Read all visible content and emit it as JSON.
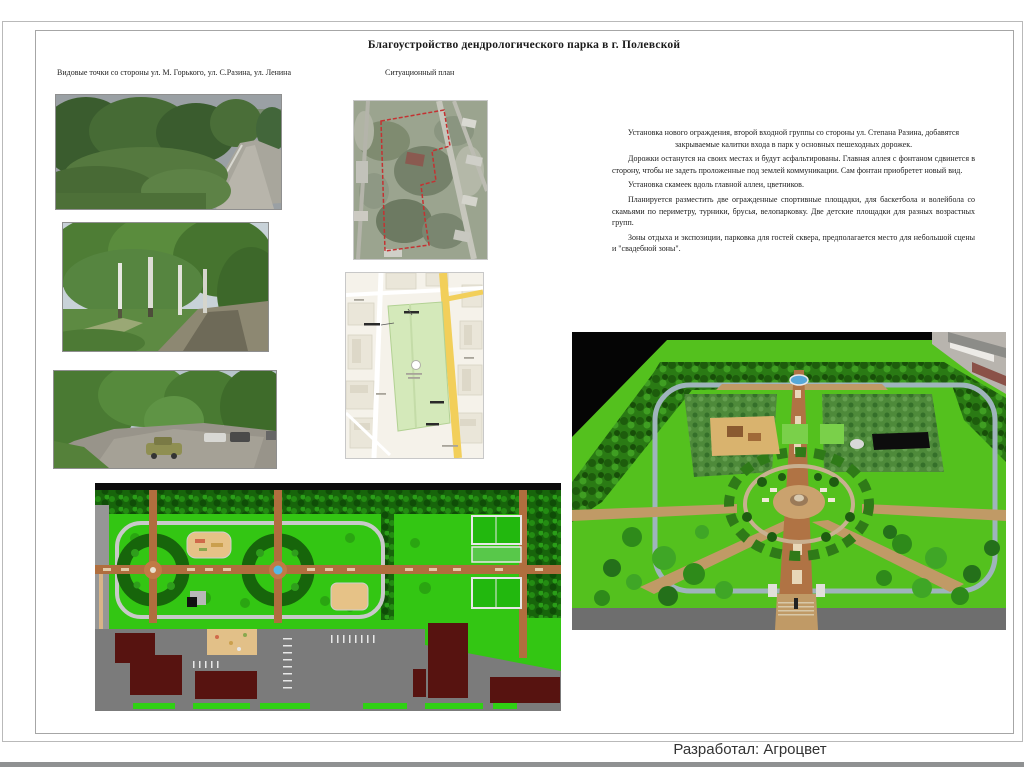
{
  "page": {
    "title": "Благоустройство дендрологического парка в г. Полевской",
    "captions": {
      "viewpoints": "Видовые точки со стороны ул. М. Горького, ул. С.Разина, ул. Ленина",
      "situational": "Ситуационный план"
    },
    "description": {
      "paragraphs": [
        "Установка нового ограждения, второй входной группы со стороны ул. Степана Разина, добавятся закрываемые калитки входа в парк у основных пешеходных дорожек.",
        "Дорожки останутся на своих местах и будут асфальтированы. Главная аллея с фонтаном сдвинется в сторону, чтобы не задеть проложенные под землей коммуникации. Сам фонтан приобретет новый вид.",
        "Установка скамеек вдоль главной аллеи, цветников.",
        "Планируется разместить две огражденные спортивные площадки, для баскетбола и волейбола со скамьями по периметру, турники, брусья, велопарковку. Две детские площадки для разных возрастных групп.",
        "Зоны отдыха и экспозиции, парковка для гостей сквера, предполагается место для небольшой сцены и \"свадебной зоны\"."
      ]
    },
    "footer": {
      "credit": "Разработал: Агроцвет"
    },
    "images": {
      "photo_1": "street view with trees and asphalt road",
      "photo_2": "alley of birch trees along dirt road",
      "photo_3": "parking area with cars among trees",
      "satellite": "satellite view with red dashed park boundary",
      "map": "city map with green park plot",
      "plan2d": "2D landscaping master plan",
      "render3d": "3D perspective render of the park"
    },
    "colors": {
      "plan_grass": "#33c613",
      "plan_tree_dark": "#17650b",
      "plan_path_brown": "#b06e3e",
      "fountain_blue": "#55b8e8",
      "building_dark_red": "#571310",
      "road_gray": "#7b7b7b",
      "map_park_green": "#d4e9ba",
      "map_road_yellow": "#f2cf5a",
      "satellite_boundary_red": "#c43232",
      "render_lawn_green": "#54c11e",
      "frame_border_gray": "#a6a6a6"
    }
  }
}
